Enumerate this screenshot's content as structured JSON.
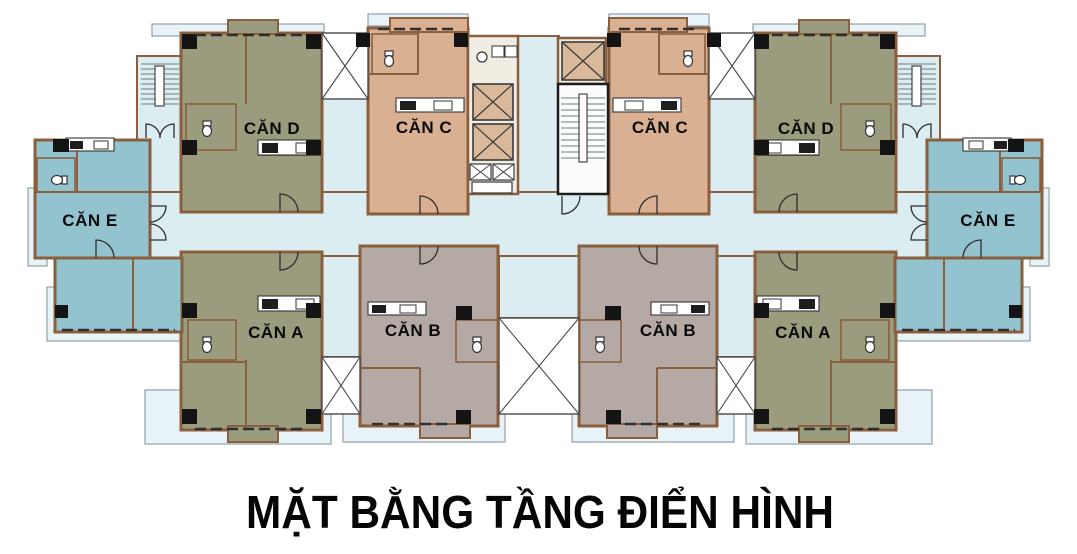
{
  "title": "MẶT BẰNG TẦNG ĐIỂN HÌNH",
  "units": [
    {
      "id": "can-d-left",
      "label": "CĂN D"
    },
    {
      "id": "can-c-left",
      "label": "CĂN C"
    },
    {
      "id": "can-c-right",
      "label": "CĂN C"
    },
    {
      "id": "can-d-right",
      "label": "CĂN D"
    },
    {
      "id": "can-e-left",
      "label": "CĂN E"
    },
    {
      "id": "can-e-right",
      "label": "CĂN E"
    },
    {
      "id": "can-a-left",
      "label": "CĂN A"
    },
    {
      "id": "can-b-left",
      "label": "CĂN B"
    },
    {
      "id": "can-b-right",
      "label": "CĂN B"
    },
    {
      "id": "can-a-right",
      "label": "CĂN A"
    }
  ],
  "colors": {
    "unit_ad": "#9a9c7d",
    "unit_b": "#b5a9a5",
    "unit_c": "#d9b091",
    "unit_e": "#93c3cf",
    "corridor": "#dcedf1",
    "balcony": "#e7f3f7",
    "wall": "#8a5f3e",
    "column": "#141414",
    "elevator": "#d9b99a",
    "title_text": "#050505"
  },
  "core": {
    "passenger_elevators": 3,
    "service_shafts": 2,
    "staircases": 3
  },
  "icons": {
    "elevator-shaft-icon": "crossed-box",
    "void-shaft-icon": "crossed-box",
    "staircase-icon": "tread-lines-with-rail",
    "toilet-icon": "ellipse-with-tank",
    "stove-icon": "black-burner-block",
    "sink-icon": "outlined-box",
    "door-swing-icon": "quarter-arc",
    "window-strip-icon": "dashed-wall-line"
  }
}
